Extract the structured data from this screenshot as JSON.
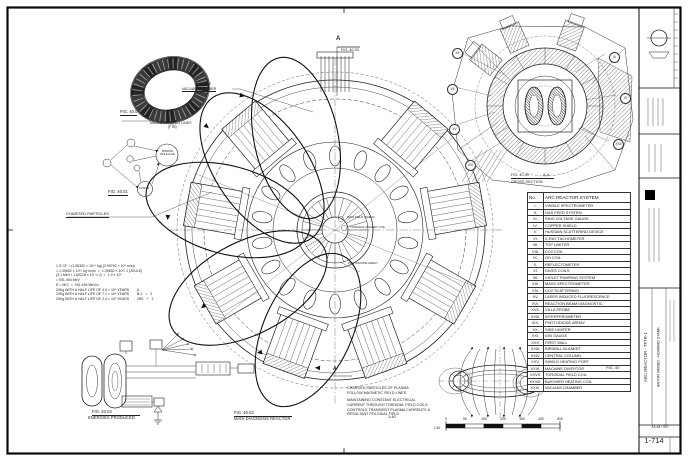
{
  "page": {
    "section_letter_top": "A",
    "section_fig_top": "FIG. 40.00",
    "section_letter_bottom": "A"
  },
  "figures": {
    "torus": {
      "label": "FIG. 40.0"
    },
    "molecule": {
      "label": "FIG. 40.01",
      "mirror_line1": "MIRROR",
      "mirror_line2": "MOLECULE",
      "fusion": "FUSION"
    },
    "main": {
      "label": "FIG. 40.02",
      "caption": "MAIN DIAGNOSIS REACTOR",
      "scale": "1:40",
      "center_labels": [
        "MAIN FIELD SHIELD",
        "TOROIDAL MAGNET COIL",
        "PHOTODIODE ARRAY"
      ]
    },
    "energy": {
      "label": "FIG. 40.04",
      "caption": "ENERGIES PRODUCED"
    },
    "orbital": {
      "label": "FIG. 40.05",
      "caption1": "ORBITAL PLOT OF",
      "caption2": "TOROIDAL ELECTRON"
    },
    "cross": {
      "label": "FIG. 40.00",
      "section": "A-A",
      "caption": "CROSS SECTION"
    }
  },
  "labels": {
    "magnetic_field_lines": "MAGNETIC FIELD LINES",
    "ftb": "(FTB)",
    "vacuum_callout": "G0800",
    "vacuum_chamber": "VACUUM CHAMBER",
    "charged_particles": "CHARGED PARTICLES"
  },
  "notes": {
    "plasma": [
      "CHARGED PARTICLES OF PLASMA",
      "FOLLOW MAGNETIC FIELD LINES"
    ],
    "current": [
      "MAINTAINING CONSTANT ELECTRICAL",
      "CURRENT THROUGH TOROIDAL FIELD COILS",
      "CONTROLS TRANSIENT PLASMA  CURRENTS &",
      "RESULTANT POLOIDAL FIELD"
    ],
    "formulas": [
      "1 G CF = (1.55352 × 10⁴⁴ kg) (2.99792 × 10⁸ m/s)²",
      "= 1.39632 × 10⁶¹ kg·m²/s²  =  1.39632 × 10⁶¹ J (JOULE)",
      "(3.1 MeV / 1.60218 × 10⁻¹³ J)  =  1.9 × 10⁷",
      "= 931.494 MeV",
      "E = MC²  =  931.494 MeV/u",
      "20Kg WITH A HALF LIFE OF 4.5 × 10⁹ YEARS        A",
      "20Kg WITH A HALF LIFE OF 7.1 × 10⁸ YEARS        B-1   =   2",
      "20Kg WITH A HALF LIFE OF 2.4 × 10⁵ YEARS        2HE   +   2"
    ]
  },
  "balloons": [
    "XII",
    "VII",
    "XV",
    "XXI",
    "IV",
    "IX",
    "XXII"
  ],
  "parts_table": {
    "header_no": "No.",
    "header_title": "ARC REACTOR SYSTEM",
    "rows": [
      [
        "I.",
        "VISIBLE SPECTROMETER"
      ],
      [
        "II.",
        "GAS FEED SYSTEM"
      ],
      [
        "III.",
        "RING VOLTAGE GAUGE"
      ],
      [
        "IV.",
        "COPPER SHIELD"
      ],
      [
        "V.",
        "HUSSAIN SCATTERING DEVICE"
      ],
      [
        "VI.",
        "X-RAY TACHOMETER"
      ],
      [
        "VII.",
        "TOP LIMITER"
      ],
      [
        "VIII.",
        "CO2 COIL"
      ],
      [
        "IX.",
        "OH COIL"
      ],
      [
        "X.",
        "REFLECTOMETER"
      ],
      [
        "XI.",
        "DIVES COILS"
      ],
      [
        "XII.",
        "VIOLET PUMPING SYSTEM"
      ],
      [
        "XIII.",
        "MASS SPECTROMETER"
      ],
      [
        "XIV.",
        "CO2 SCATTERING"
      ],
      [
        "XV.",
        "LASER INDUCED FLUORESCENCE"
      ],
      [
        "XVI.",
        "REACTION BEAM DIAGNOSTIC"
      ],
      [
        "XVII.",
        "VILLA PROBE"
      ],
      [
        "XVIII.",
        "INTERFEROMETER"
      ],
      [
        "XIX.",
        "PHOTODIODE ARRAY"
      ],
      [
        "XX.",
        "SIDE LIMITER"
      ],
      [
        "XXI.",
        "ION GAUGE"
      ],
      [
        "XXII.",
        "FIRST WALL"
      ],
      [
        "XXIII.",
        "BIRDBILL BLANKET"
      ],
      [
        "XXIV.",
        "CENTRAL COLUMN"
      ],
      [
        "XXV.",
        "SHIELD HEATING PORT"
      ],
      [
        "XXVI.",
        "MACHINE DIVERTOR"
      ],
      [
        "XXVII.",
        "TOROIDAL FIELD COIL"
      ],
      [
        "XXVIII.",
        "BUKSHER HEATING COIL"
      ],
      [
        "XXIX.",
        "VACUUM CHAMBER"
      ]
    ],
    "fig_ref": "FIG. 40"
  },
  "scale_bar": {
    "zero": "0",
    "ticks": [
      "50",
      "100",
      "200",
      "300",
      "400",
      "500"
    ],
    "ratio": "1:40"
  },
  "title_block": {
    "title": "ARC REACTOR - TFTR-1",
    "author": "ANTON VAMBO - HOWARD STARK",
    "format": "A3-A4 / ISO",
    "sheet": "1-714"
  }
}
